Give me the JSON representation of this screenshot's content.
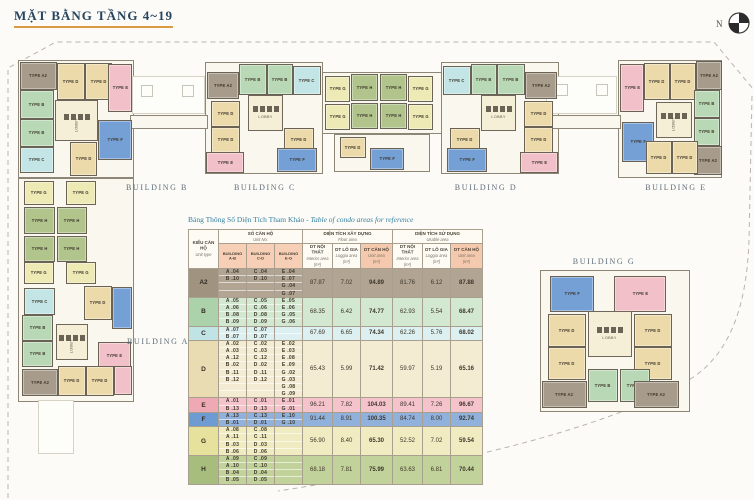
{
  "title": "MẶT BẰNG TẦNG 4~19",
  "compass": {
    "label": "N"
  },
  "plan": {
    "lobby_label": "LOBBY",
    "unit_types": [
      {
        "code": "A2",
        "label": "TYPE A2",
        "color": "#a79b8b"
      },
      {
        "code": "B",
        "label": "TYPE B",
        "color": "#b9d9b6"
      },
      {
        "code": "C",
        "label": "TYPE C",
        "color": "#c3e5e6"
      },
      {
        "code": "D",
        "label": "TYPE D",
        "color": "#ecdaaa"
      },
      {
        "code": "E",
        "label": "TYPE E",
        "color": "#f2c0c8"
      },
      {
        "code": "F",
        "label": "TYPE F",
        "color": "#74a0d6"
      },
      {
        "code": "G",
        "label": "TYPE G",
        "color": "#eeeab6"
      },
      {
        "code": "H",
        "label": "TYPE H",
        "color": "#b0c48c"
      }
    ],
    "building_labels": [
      {
        "name": "BUILDING A",
        "x": 158,
        "y": 337
      },
      {
        "name": "BUILDING B",
        "x": 157,
        "y": 183
      },
      {
        "name": "BUILDING C",
        "x": 265,
        "y": 183
      },
      {
        "name": "BUILDING D",
        "x": 486,
        "y": 183
      },
      {
        "name": "BUILDING E",
        "x": 676,
        "y": 183
      },
      {
        "name": "BUILDING G",
        "x": 604,
        "y": 257
      }
    ],
    "bases": [
      {
        "x": 18,
        "y": 60,
        "w": 116,
        "h": 118
      },
      {
        "x": 205,
        "y": 62,
        "w": 118,
        "h": 112
      },
      {
        "x": 322,
        "y": 72,
        "w": 120,
        "h": 62
      },
      {
        "x": 334,
        "y": 134,
        "w": 96,
        "h": 38
      },
      {
        "x": 441,
        "y": 62,
        "w": 118,
        "h": 112
      },
      {
        "x": 618,
        "y": 60,
        "w": 104,
        "h": 118
      },
      {
        "x": 18,
        "y": 178,
        "w": 116,
        "h": 224
      },
      {
        "x": 540,
        "y": 270,
        "w": 150,
        "h": 142
      },
      {
        "x": 130,
        "y": 115,
        "w": 78,
        "h": 14
      },
      {
        "x": 543,
        "y": 115,
        "w": 78,
        "h": 14
      }
    ],
    "courts": [
      {
        "x": 132,
        "y": 76,
        "w": 73,
        "h": 38
      },
      {
        "x": 546,
        "y": 76,
        "w": 71,
        "h": 38
      },
      {
        "x": 38,
        "y": 400,
        "w": 36,
        "h": 54
      }
    ],
    "squares": [
      {
        "x": 141,
        "y": 85,
        "w": 12,
        "h": 12
      },
      {
        "x": 182,
        "y": 85,
        "w": 12,
        "h": 12
      },
      {
        "x": 556,
        "y": 84,
        "w": 12,
        "h": 12
      },
      {
        "x": 596,
        "y": 84,
        "w": 12,
        "h": 12
      }
    ],
    "cores": [
      {
        "x": 55,
        "y": 100,
        "w": 43,
        "h": 41,
        "dir": "v"
      },
      {
        "x": 248,
        "y": 95,
        "w": 35,
        "h": 36,
        "dir": "h"
      },
      {
        "x": 481,
        "y": 95,
        "w": 35,
        "h": 36,
        "dir": "h"
      },
      {
        "x": 656,
        "y": 102,
        "w": 36,
        "h": 36,
        "dir": "v"
      },
      {
        "x": 56,
        "y": 324,
        "w": 32,
        "h": 36,
        "dir": "v"
      },
      {
        "x": 588,
        "y": 311,
        "w": 44,
        "h": 46,
        "dir": "h"
      }
    ],
    "blocks": [
      {
        "t": "A2",
        "x": 20,
        "y": 62,
        "w": 37,
        "h": 28
      },
      {
        "t": "D",
        "x": 57,
        "y": 63,
        "w": 28,
        "h": 37
      },
      {
        "t": "D",
        "x": 85,
        "y": 63,
        "w": 27,
        "h": 37
      },
      {
        "t": "E",
        "x": 108,
        "y": 64,
        "w": 24,
        "h": 48
      },
      {
        "t": "B",
        "x": 20,
        "y": 90,
        "w": 34,
        "h": 29
      },
      {
        "t": "B",
        "x": 20,
        "y": 119,
        "w": 34,
        "h": 28
      },
      {
        "t": "C",
        "x": 20,
        "y": 147,
        "w": 34,
        "h": 26
      },
      {
        "t": "F",
        "x": 98,
        "y": 120,
        "w": 34,
        "h": 40
      },
      {
        "t": "D",
        "x": 70,
        "y": 142,
        "w": 27,
        "h": 34
      },
      {
        "t": "A2",
        "x": 207,
        "y": 72,
        "w": 32,
        "h": 27
      },
      {
        "t": "B",
        "x": 239,
        "y": 64,
        "w": 28,
        "h": 31
      },
      {
        "t": "B",
        "x": 267,
        "y": 64,
        "w": 26,
        "h": 31
      },
      {
        "t": "C",
        "x": 293,
        "y": 66,
        "w": 28,
        "h": 29
      },
      {
        "t": "D",
        "x": 211,
        "y": 101,
        "w": 29,
        "h": 26
      },
      {
        "t": "D",
        "x": 211,
        "y": 127,
        "w": 29,
        "h": 26
      },
      {
        "t": "D",
        "x": 284,
        "y": 128,
        "w": 30,
        "h": 24
      },
      {
        "t": "E",
        "x": 206,
        "y": 152,
        "w": 38,
        "h": 21
      },
      {
        "t": "F",
        "x": 277,
        "y": 148,
        "w": 40,
        "h": 24
      },
      {
        "t": "G",
        "x": 325,
        "y": 76,
        "w": 25,
        "h": 26
      },
      {
        "t": "H",
        "x": 351,
        "y": 74,
        "w": 27,
        "h": 27
      },
      {
        "t": "H",
        "x": 380,
        "y": 74,
        "w": 27,
        "h": 27
      },
      {
        "t": "G",
        "x": 408,
        "y": 76,
        "w": 25,
        "h": 26
      },
      {
        "t": "G",
        "x": 325,
        "y": 104,
        "w": 25,
        "h": 26
      },
      {
        "t": "H",
        "x": 351,
        "y": 103,
        "w": 27,
        "h": 26
      },
      {
        "t": "H",
        "x": 380,
        "y": 103,
        "w": 27,
        "h": 26
      },
      {
        "t": "G",
        "x": 408,
        "y": 104,
        "w": 25,
        "h": 26
      },
      {
        "t": "D",
        "x": 340,
        "y": 137,
        "w": 26,
        "h": 21
      },
      {
        "t": "F",
        "x": 370,
        "y": 148,
        "w": 34,
        "h": 22
      },
      {
        "t": "C",
        "x": 443,
        "y": 66,
        "w": 28,
        "h": 29
      },
      {
        "t": "B",
        "x": 471,
        "y": 64,
        "w": 26,
        "h": 31
      },
      {
        "t": "B",
        "x": 497,
        "y": 64,
        "w": 28,
        "h": 31
      },
      {
        "t": "A2",
        "x": 525,
        "y": 72,
        "w": 32,
        "h": 27
      },
      {
        "t": "D",
        "x": 524,
        "y": 101,
        "w": 29,
        "h": 26
      },
      {
        "t": "D",
        "x": 524,
        "y": 127,
        "w": 29,
        "h": 26
      },
      {
        "t": "D",
        "x": 450,
        "y": 128,
        "w": 30,
        "h": 24
      },
      {
        "t": "E",
        "x": 520,
        "y": 152,
        "w": 38,
        "h": 21
      },
      {
        "t": "F",
        "x": 447,
        "y": 148,
        "w": 40,
        "h": 24
      },
      {
        "t": "E",
        "x": 620,
        "y": 64,
        "w": 24,
        "h": 48
      },
      {
        "t": "D",
        "x": 644,
        "y": 63,
        "w": 26,
        "h": 37
      },
      {
        "t": "D",
        "x": 670,
        "y": 63,
        "w": 26,
        "h": 37
      },
      {
        "t": "A2",
        "x": 696,
        "y": 61,
        "w": 26,
        "h": 29
      },
      {
        "t": "B",
        "x": 694,
        "y": 90,
        "w": 26,
        "h": 28
      },
      {
        "t": "B",
        "x": 694,
        "y": 118,
        "w": 26,
        "h": 28
      },
      {
        "t": "A2",
        "x": 694,
        "y": 146,
        "w": 28,
        "h": 29
      },
      {
        "t": "F",
        "x": 622,
        "y": 122,
        "w": 32,
        "h": 40
      },
      {
        "t": "D",
        "x": 646,
        "y": 141,
        "w": 26,
        "h": 33
      },
      {
        "t": "D",
        "x": 672,
        "y": 141,
        "w": 26,
        "h": 33
      },
      {
        "t": "G",
        "x": 24,
        "y": 181,
        "w": 30,
        "h": 24
      },
      {
        "t": "G",
        "x": 66,
        "y": 181,
        "w": 30,
        "h": 24
      },
      {
        "t": "H",
        "x": 24,
        "y": 207,
        "w": 31,
        "h": 27
      },
      {
        "t": "H",
        "x": 57,
        "y": 207,
        "w": 30,
        "h": 27
      },
      {
        "t": "H",
        "x": 24,
        "y": 236,
        "w": 31,
        "h": 26
      },
      {
        "t": "H",
        "x": 57,
        "y": 236,
        "w": 30,
        "h": 26
      },
      {
        "t": "G",
        "x": 24,
        "y": 262,
        "w": 30,
        "h": 22
      },
      {
        "t": "G",
        "x": 66,
        "y": 262,
        "w": 30,
        "h": 22
      },
      {
        "t": "C",
        "x": 24,
        "y": 288,
        "w": 31,
        "h": 27
      },
      {
        "t": "D",
        "x": 84,
        "y": 286,
        "w": 28,
        "h": 34
      },
      {
        "t": "F",
        "x": 112,
        "y": 287,
        "w": 20,
        "h": 42
      },
      {
        "t": "B",
        "x": 22,
        "y": 315,
        "w": 31,
        "h": 26
      },
      {
        "t": "B",
        "x": 22,
        "y": 341,
        "w": 31,
        "h": 26
      },
      {
        "t": "E",
        "x": 98,
        "y": 342,
        "w": 33,
        "h": 28
      },
      {
        "t": "A2",
        "x": 22,
        "y": 369,
        "w": 36,
        "h": 27
      },
      {
        "t": "D",
        "x": 58,
        "y": 366,
        "w": 28,
        "h": 30
      },
      {
        "t": "D",
        "x": 86,
        "y": 366,
        "w": 28,
        "h": 30
      },
      {
        "t": "E",
        "x": 114,
        "y": 366,
        "w": 18,
        "h": 29
      },
      {
        "t": "F",
        "x": 550,
        "y": 276,
        "w": 44,
        "h": 36
      },
      {
        "t": "E",
        "x": 614,
        "y": 276,
        "w": 52,
        "h": 36
      },
      {
        "t": "D",
        "x": 548,
        "y": 314,
        "w": 38,
        "h": 33
      },
      {
        "t": "D",
        "x": 548,
        "y": 347,
        "w": 38,
        "h": 33
      },
      {
        "t": "D",
        "x": 634,
        "y": 314,
        "w": 38,
        "h": 33
      },
      {
        "t": "D",
        "x": 634,
        "y": 347,
        "w": 38,
        "h": 33
      },
      {
        "t": "B",
        "x": 588,
        "y": 369,
        "w": 30,
        "h": 33
      },
      {
        "t": "B",
        "x": 620,
        "y": 369,
        "w": 30,
        "h": 33
      },
      {
        "t": "A2",
        "x": 542,
        "y": 381,
        "w": 45,
        "h": 27
      },
      {
        "t": "A2",
        "x": 634,
        "y": 381,
        "w": 45,
        "h": 27
      }
    ]
  },
  "table": {
    "title_vn": "Bảng Thông Số Diện Tích Tham Khảo",
    "title_en": " - Table of condo areas for reference",
    "header": {
      "unit_type_vn": "KIỂU CĂN HỘ",
      "unit_type_en": "Unit type",
      "unit_no_vn": "SỐ CĂN HỘ",
      "unit_no_en": "Unit No.",
      "floor_vn": "DIỆN TÍCH XÂY DỰNG",
      "floor_en": "Floor area",
      "usable_vn": "DIỆN TÍCH SỬ DỤNG",
      "usable_en": "Usable area",
      "interior_vn": "DT NỘI THẤT",
      "interior_en": "Interior area",
      "loggia_vn": "DT LÔ GIA",
      "loggia_en": "Loggia area",
      "unit_area_vn": "DT CĂN HỘ",
      "unit_area_en": "Unit area",
      "m2": "(m²)",
      "buildings": [
        "BUILDING A-B",
        "BUILDING C-D",
        "BUILDING E-G"
      ]
    },
    "rows": [
      {
        "type": "A2",
        "label_bg": "#a09380",
        "row_bg": "#b1a493",
        "units_ab": [
          "A .04",
          "B .10"
        ],
        "units_cd": [
          "C .04",
          "D .10"
        ],
        "units_eg": [
          "E .04",
          "E .07",
          "G .04",
          "G .07"
        ],
        "floor": [
          "87.87",
          "7.02",
          "94.89"
        ],
        "usable": [
          "81.76",
          "6.12",
          "87.88"
        ]
      },
      {
        "type": "B",
        "label_bg": "#abd2ab",
        "row_bg": "#d3e8d0",
        "units_ab": [
          "A .05",
          "A .06",
          "B .08",
          "B .09"
        ],
        "units_cd": [
          "C .05",
          "C .06",
          "D .08",
          "D .09"
        ],
        "units_eg": [
          "E .05",
          "E .06",
          "G .05",
          "G .06"
        ],
        "floor": [
          "68.35",
          "6.42",
          "74.77"
        ],
        "usable": [
          "62.93",
          "5.54",
          "68.47"
        ]
      },
      {
        "type": "C",
        "label_bg": "#c0e3e5",
        "row_bg": "#dcf0f1",
        "units_ab": [
          "A .07",
          "B .07"
        ],
        "units_cd": [
          "C .07",
          "D .07"
        ],
        "units_eg": [],
        "floor": [
          "67.69",
          "6.65",
          "74.34"
        ],
        "usable": [
          "62.26",
          "5.76",
          "68.02"
        ]
      },
      {
        "type": "D",
        "label_bg": "#eadcb2",
        "row_bg": "#f4ecd2",
        "units_ab": [
          "A .02",
          "A .03",
          "A .12",
          "B .02",
          "B .11",
          "B .12"
        ],
        "units_cd": [
          "C .02",
          "C .03",
          "C .12",
          "D .02",
          "D .11",
          "D .12"
        ],
        "units_eg": [
          "E .02",
          "E .03",
          "E .08",
          "E .09",
          "G .02",
          "G .03",
          "G .08",
          "G .09"
        ],
        "floor": [
          "65.43",
          "5.99",
          "71.42"
        ],
        "usable": [
          "59.97",
          "5.19",
          "65.16"
        ]
      },
      {
        "type": "E",
        "label_bg": "#efa9b5",
        "row_bg": "#f5c3cb",
        "units_ab": [
          "A .01",
          "B .13"
        ],
        "units_cd": [
          "C .01",
          "D .13"
        ],
        "units_eg": [
          "E .01",
          "G .01"
        ],
        "floor": [
          "96.21",
          "7.82",
          "104.03"
        ],
        "usable": [
          "89.41",
          "7.26",
          "96.67"
        ]
      },
      {
        "type": "F",
        "label_bg": "#6f9bd3",
        "row_bg": "#90b1dc",
        "units_ab": [
          "A .13",
          "B .01"
        ],
        "units_cd": [
          "C .13",
          "D .01"
        ],
        "units_eg": [
          "E .10",
          "G .10"
        ],
        "floor": [
          "91.44",
          "8.91",
          "100.35"
        ],
        "usable": [
          "84.74",
          "8.00",
          "92.74"
        ]
      },
      {
        "type": "G",
        "label_bg": "#e7e19e",
        "row_bg": "#f0ebc0",
        "units_ab": [
          "A .08",
          "A .11",
          "B .03",
          "B .06"
        ],
        "units_cd": [
          "C .08",
          "C .11",
          "D .03",
          "D .06"
        ],
        "units_eg": [],
        "floor": [
          "56.90",
          "8.40",
          "65.30"
        ],
        "usable": [
          "52.52",
          "7.02",
          "59.54"
        ]
      },
      {
        "type": "H",
        "label_bg": "#a6bd7d",
        "row_bg": "#c2d29b",
        "units_ab": [
          "A .09",
          "A .10",
          "B .04",
          "B .05"
        ],
        "units_cd": [
          "C .09",
          "C .10",
          "D .04",
          "D .05"
        ],
        "units_eg": [],
        "floor": [
          "68.18",
          "7.81",
          "75.99"
        ],
        "usable": [
          "63.63",
          "6.81",
          "70.44"
        ]
      }
    ]
  }
}
